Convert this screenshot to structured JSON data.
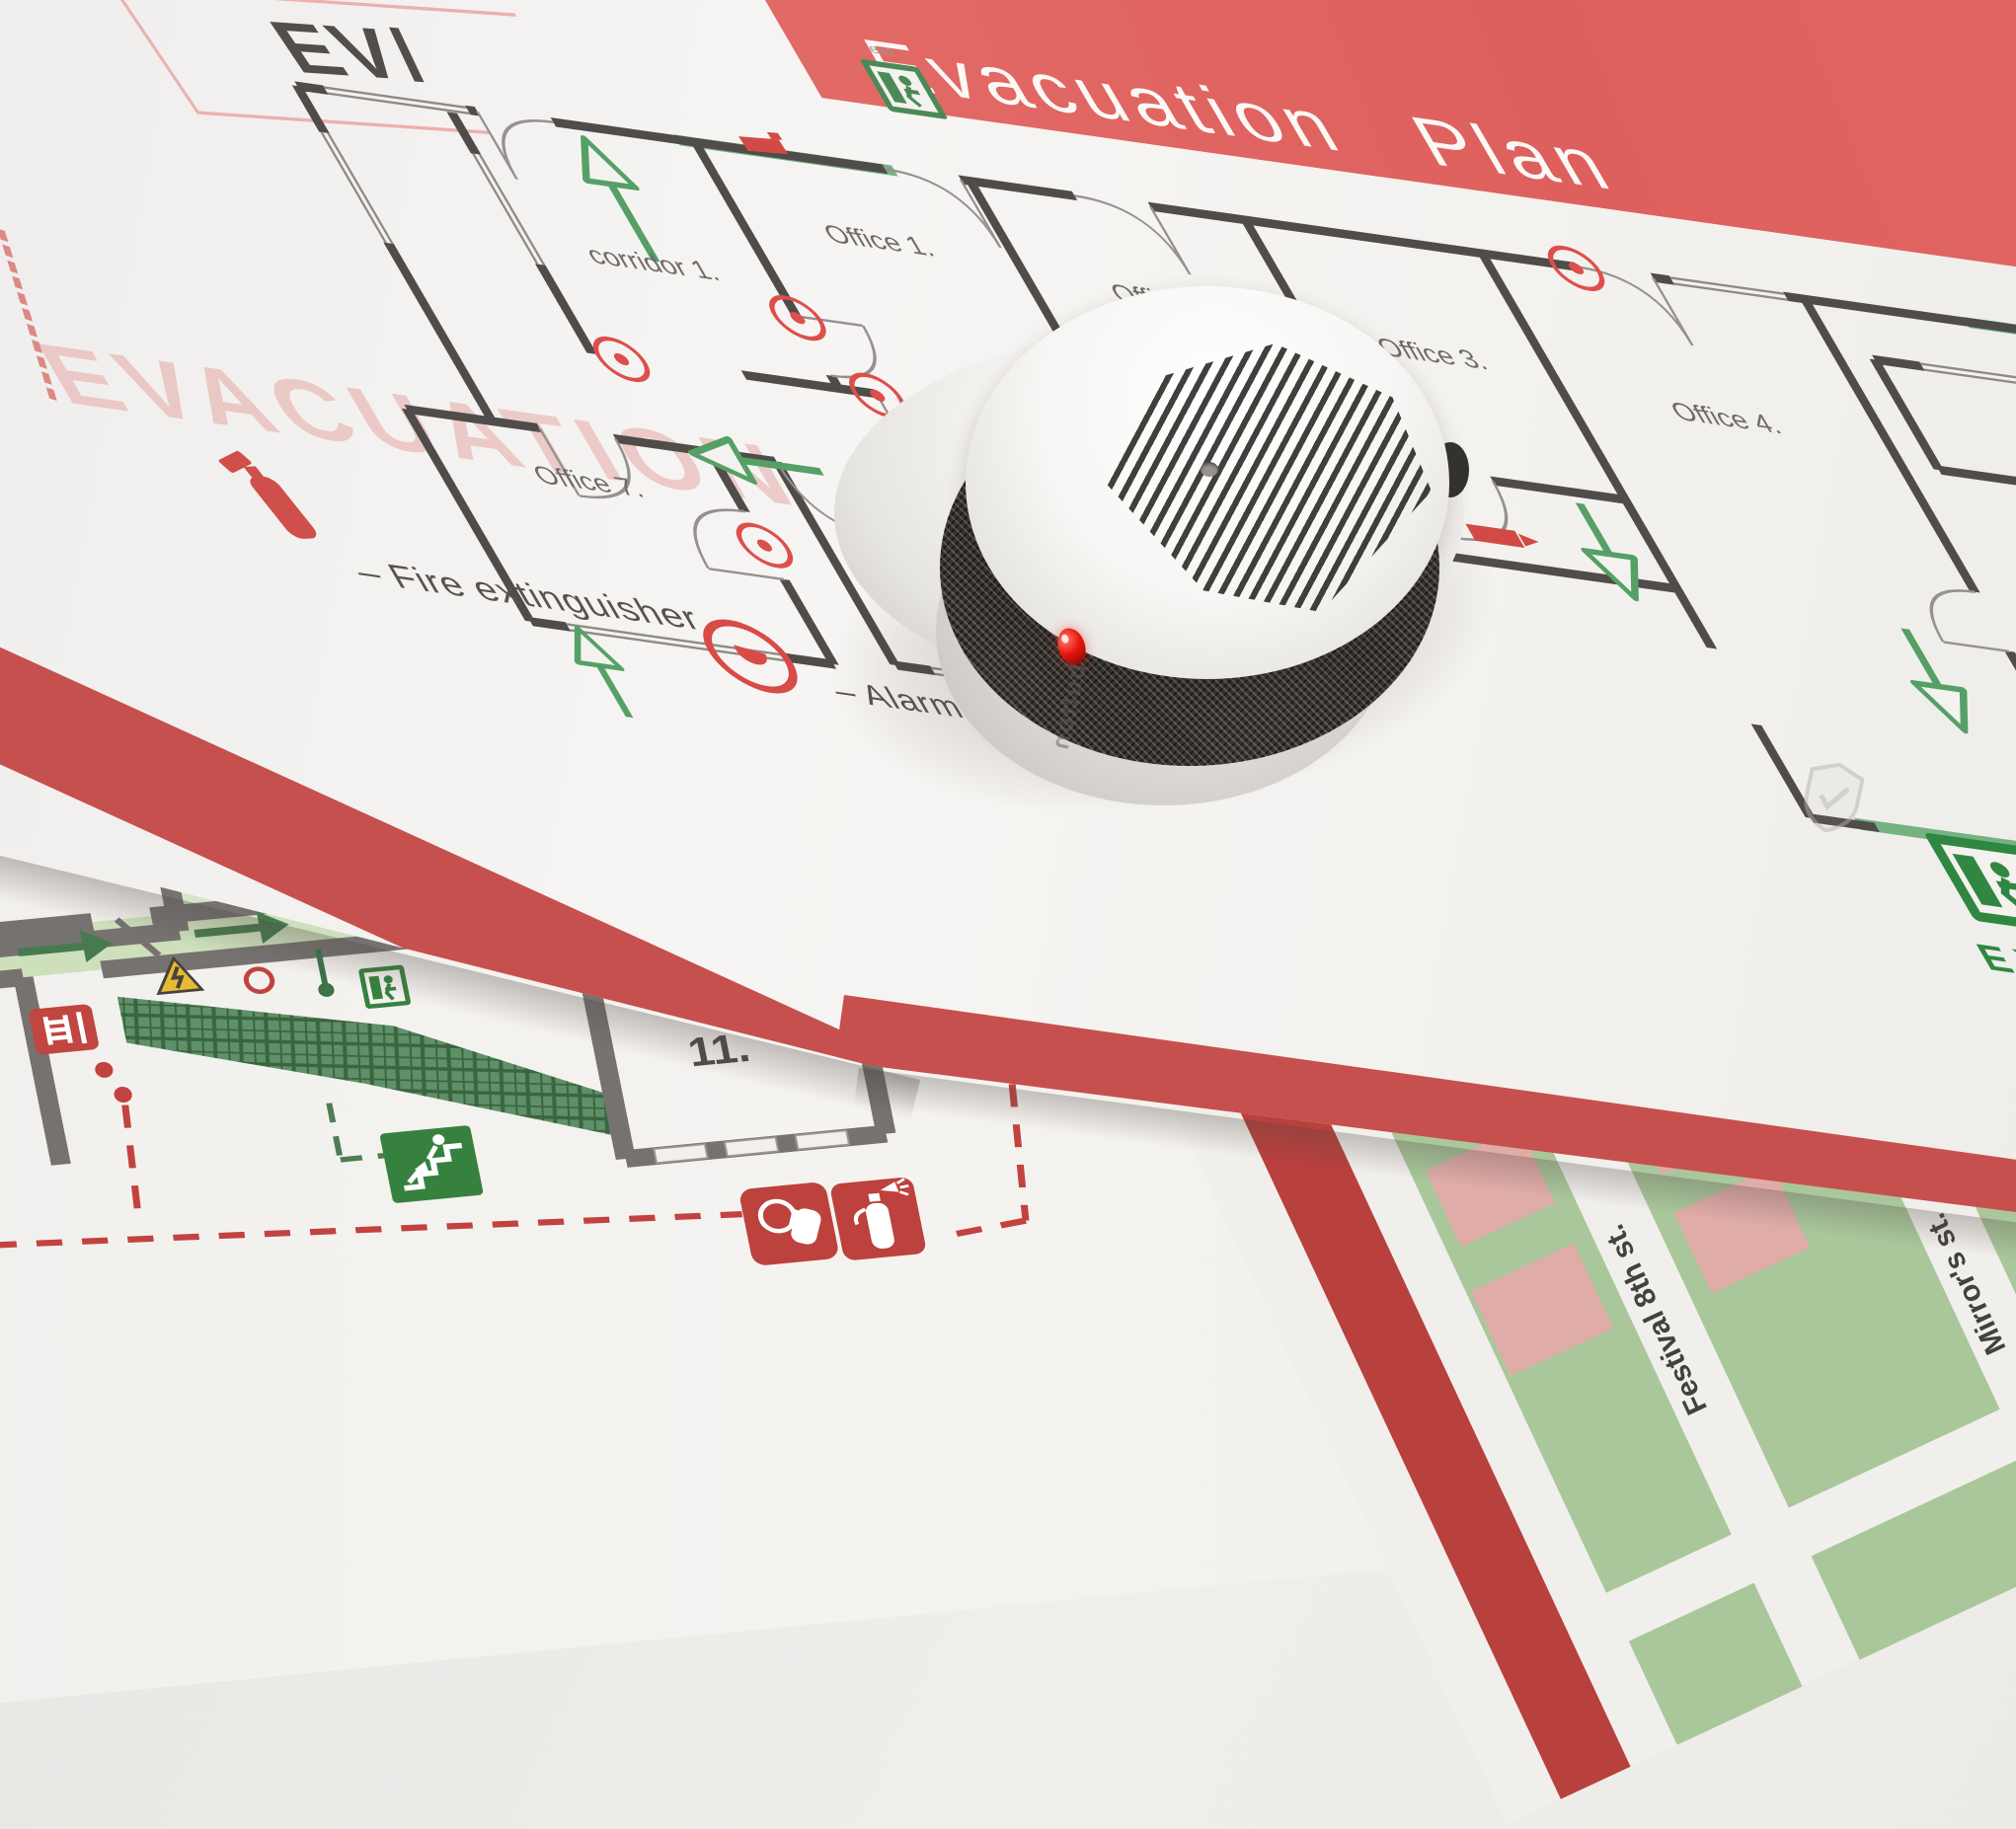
{
  "banner": {
    "title": "Evacuation Plan"
  },
  "logo": {
    "text": "EV/"
  },
  "watermark": {
    "text": "EVACUATION"
  },
  "floor_plan": {
    "rooms": {
      "corridor1": "corridor 1.",
      "office1": "Office 1.",
      "office2": "Office 2.",
      "office3": "Office 3.",
      "office4": "Office 4.",
      "wc": "WC",
      "office5": "Office 5.",
      "office7": "Office 7.",
      "corridor2": "corridor 2."
    },
    "legend": {
      "fire_extinguisher": "– Fire extinguisher",
      "alarm_button": "– Alarm button"
    },
    "exit_sign_small": "exit",
    "exit_sign_large": "EXIT"
  },
  "site_plan": {
    "room5": "5.",
    "room11": "11."
  },
  "street_map": {
    "street1": "Festival 8th st.",
    "street2": "Mirror's st."
  },
  "detector": {
    "reflection_text": "button"
  },
  "colors": {
    "banner_red": "#df6360",
    "stripe_red": "#c6504d",
    "deep_red": "#b8403d",
    "icon_red": "#c14540",
    "wall_gray": "#4f4c4a",
    "arrow_green": "#55a066",
    "sign_green": "#37813f",
    "paper": "#f4f2ef",
    "hazard_yellow": "#e7bb31"
  }
}
